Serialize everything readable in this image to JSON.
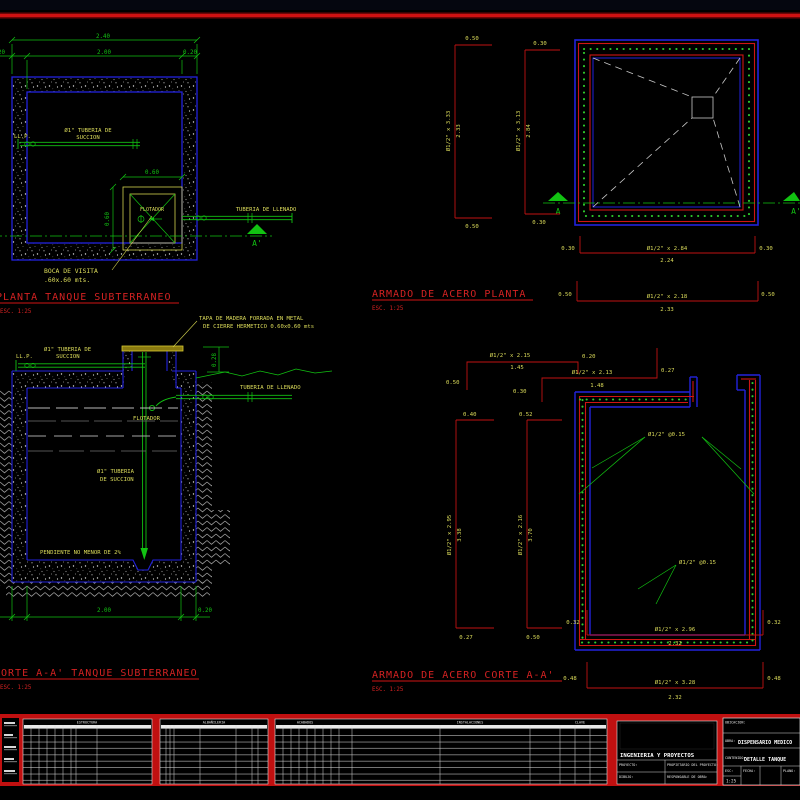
{
  "planta": {
    "title": "PLANTA TANQUE SUBTERRANEO",
    "scale": "ESC. 1:25",
    "dim_total": "2.40",
    "dim_inner": "2.00",
    "dim_wall_r": "0.20",
    "dim_wall_l": "0.20",
    "llp": "LL.P.",
    "suction1": "Ø1\" TUBERIA DE",
    "suction2": "SUCCION",
    "boca_dim_w": "0.60",
    "boca_dim_h": "0.60",
    "flotador": "FLOTADOR",
    "llenado": "TUBERIA DE LLENADO",
    "marker": "A'",
    "boca1": "BOCA DE VISITA",
    "boca2": ".60x.60 mts."
  },
  "armado_planta": {
    "title": "ARMADO DE ACERO PLANTA",
    "scale": "ESC. 1:25",
    "v1_top": "0.50",
    "v1_bot": "0.50",
    "v1_bar": "Ø1/2\" x 3.33",
    "v1_val": "2.33",
    "v2_top": "0.30",
    "v2_bot": "0.30",
    "v2_bar": "Ø1/2\" x 3.13",
    "v2_val": "2.84",
    "h1_l": "0.30",
    "h1_r": "0.30",
    "h1_bar": "Ø1/2\" x 2.84",
    "h1_val": "2.24",
    "h2_l": "0.50",
    "h2_r": "0.50",
    "h2_bar": "Ø1/2\" x 2.18",
    "h2_val": "2.33",
    "marker_l": "A",
    "marker_r": "A'"
  },
  "corte": {
    "title": "CORTE A-A' TANQUE SUBTERRANEO",
    "scale": "ESC. 1:25",
    "tapa1": "TAPA DE MADERA FORRADA EN METAL",
    "tapa2": "DE CIERRE HERMETICO 0.60x0.60 mts",
    "llp": "LL.P.",
    "suction1": "Ø1\" TUBERIA DE",
    "suction2": "SUCCION",
    "llenado": "TUBERIA DE LLENADO",
    "flotador": "FLOTADOR",
    "suction_mid1": "Ø1\" TUBERIA",
    "suction_mid2": "DE SUCCION",
    "pendiente": "PENDIENTE NO MENOR DE 2%",
    "dim_top": "0.28",
    "dim_inner": "2.00",
    "dim_wall": "0.20"
  },
  "armado_corte": {
    "title": "ARMADO DE ACERO CORTE A-A'",
    "scale": "ESC. 1:25",
    "t1_bar": "Ø1/2\" x 2.15",
    "t1_val": "1.45",
    "t1_hook": "0.20",
    "t1_leg": "0.50",
    "t2_bar": "Ø1/2\" x 2.13",
    "t2_val": "1.48",
    "t2_hook": "0.27",
    "t2_leg": "0.30",
    "v1_top": "0.40",
    "v1_bar": "Ø1/2\" x 2.95",
    "v1_val": "3.38",
    "v1_bot": "0.27",
    "v2_top": "0.52",
    "v2_bar": "Ø1/2\" x 2.16",
    "v2_val": "3.70",
    "v2_bot": "0.50",
    "esp_top": "Ø1/2\" @0.15",
    "esp_bot": "Ø1/2\" @0.15",
    "b1_l": "0.32",
    "b1_r": "0.32",
    "b1_bar": "Ø1/2\" x 2.96",
    "b1_val": "2.32",
    "b2_l": "0.48",
    "b2_r": "0.48",
    "b2_bar": "Ø1/2\" x 3.28",
    "b2_val": "2.32"
  },
  "titleblock": {
    "table1": "ESTRUCTURA",
    "table2": "ALBAÑILERIA",
    "table3a": "ACABADOS",
    "table3b": "INSTALACIONES",
    "table3c": "CLAVE",
    "firm": "INGENIERIA Y PROYECTOS",
    "f1": "PROYECTO:",
    "f2": "PROPIETARIO DEL PROYECTO:",
    "f3": "DIBUJO:",
    "f4": "RESPONSABLE DE OBRA:",
    "ubicacion": "UBICACION:",
    "obra": "OBRA:",
    "obra_value": "DISPENSARIO MEDICO",
    "contenido": "CONTENIDO:",
    "contenido_value": "DETALLE TANQUE",
    "esc": "ESC:",
    "esc_value": "1:25",
    "fecha": "FECHA:",
    "plano": "PLANO:"
  }
}
